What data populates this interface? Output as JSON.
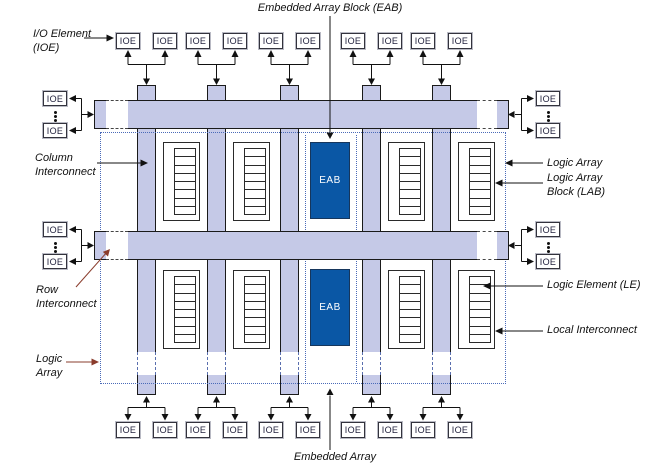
{
  "diagram": {
    "labels": {
      "title_top": "Embedded Array Block (EAB)",
      "title_bottom": "Embedded Array",
      "io_element": "I/O Element\n(IOE)",
      "column_interconnect": "Column\nInterconnect",
      "row_interconnect": "Row\nInterconnect",
      "logic_array_left": "Logic\nArray",
      "logic_array_right": "Logic Array",
      "logic_array_block": "Logic Array\nBlock (LAB)",
      "logic_element": "Logic Element (LE)",
      "local_interconnect": "Local Interconnect"
    },
    "ioe_label": "IOE",
    "eab_label": "EAB",
    "counts": {
      "top_ioe": 10,
      "bottom_ioe": 10,
      "left_ioe": 4,
      "right_ioe": 4,
      "columns": 5,
      "row_bands": 2,
      "labs": 8,
      "eabs": 2,
      "logic_elements_per_lab": 8
    },
    "colors": {
      "background": "#ffffff",
      "interconnect_fill": "#c5c9e7",
      "interconnect_border": "#1a1a1a",
      "eab_fill": "#0a57a5",
      "eab_border": "#16365c",
      "dotted_border": "#4a6ab8",
      "label_text": "#111111",
      "callout_brown": "#8a3c2c",
      "callout_black": "#111111"
    }
  }
}
